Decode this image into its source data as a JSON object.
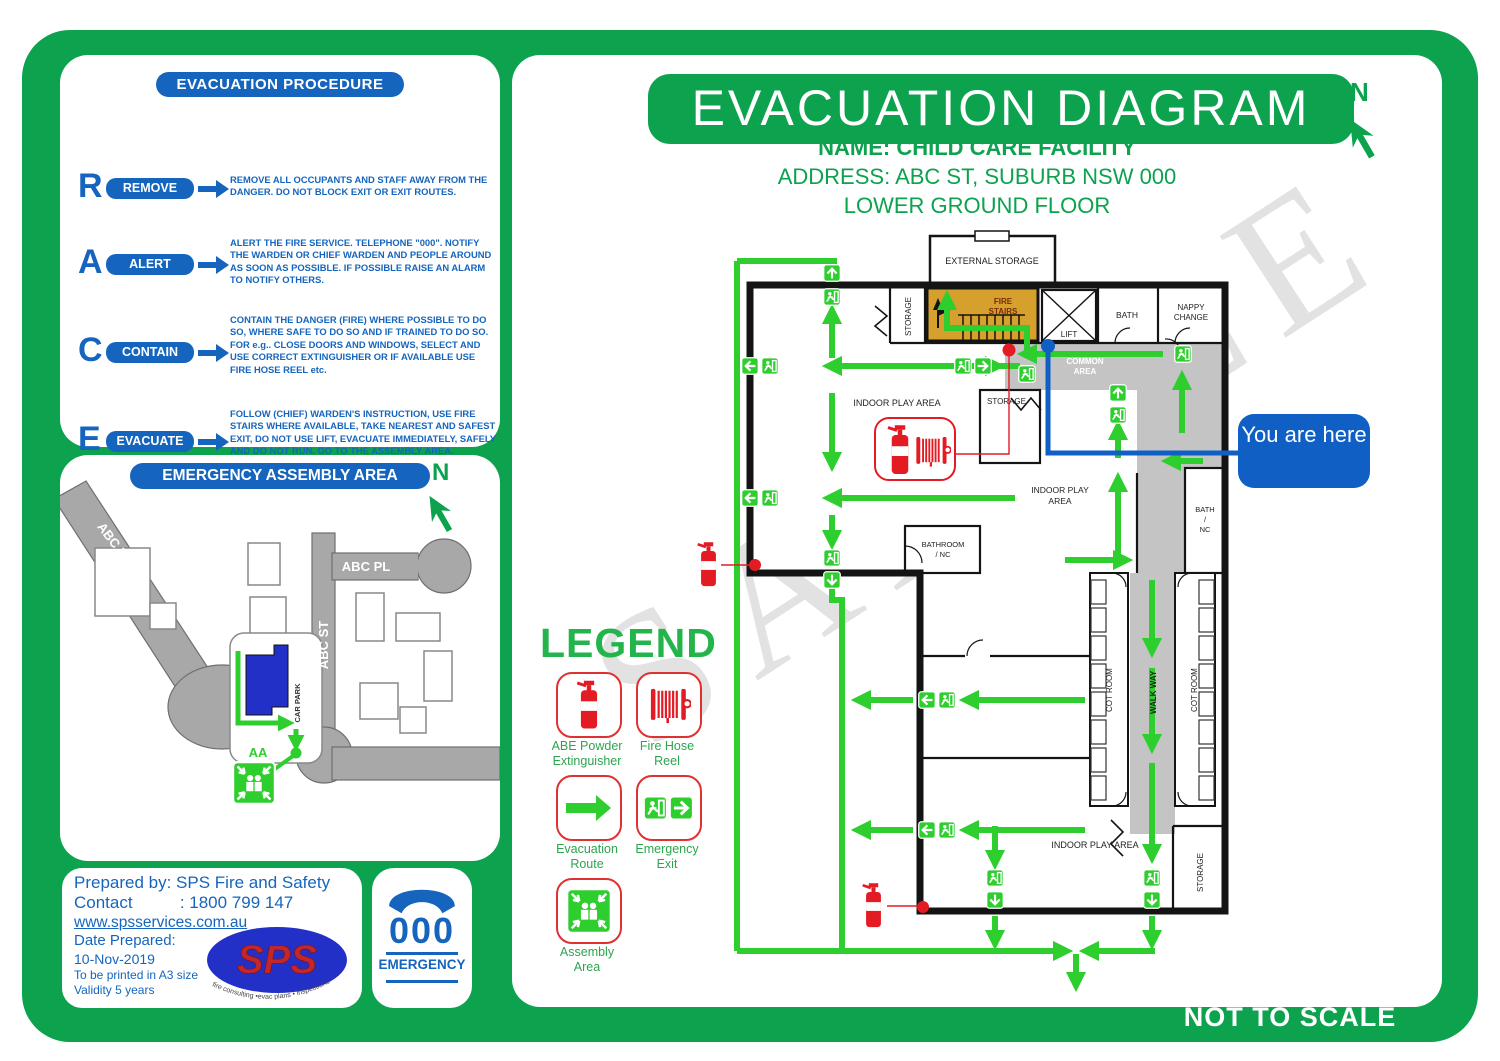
{
  "header": {
    "title": "EVACUATION DIAGRAM",
    "name": "NAME: CHILD CARE FACILITY",
    "address": "ADDRESS: ABC ST, SUBURB NSW 000",
    "floor": "LOWER GROUND FLOOR",
    "north": "N",
    "not_to_scale": "NOT TO SCALE"
  },
  "watermark": "SAMPLE",
  "you_are_here": "You are here",
  "procedure": {
    "title": "EVACUATION PROCEDURE",
    "steps": [
      {
        "letter": "R",
        "label": "REMOVE",
        "text": "REMOVE ALL OCCUPANTS AND STAFF AWAY FROM THE DANGER. DO NOT BLOCK EXIT OR EXIT ROUTES."
      },
      {
        "letter": "A",
        "label": "ALERT",
        "text": "ALERT THE FIRE SERVICE. TELEPHONE \"000\". NOTIFY THE WARDEN OR CHIEF WARDEN AND PEOPLE AROUND AS SOON AS POSSIBLE. IF POSSIBLE RAISE AN ALARM TO NOTIFY OTHERS."
      },
      {
        "letter": "C",
        "label": "CONTAIN",
        "text": "CONTAIN THE DANGER (FIRE) WHERE POSSIBLE TO DO SO, WHERE SAFE TO DO SO AND IF TRAINED TO DO SO. FOR e.g.. CLOSE DOORS AND WINDOWS, SELECT AND USE CORRECT EXTINGUISHER OR IF AVAILABLE USE FIRE HOSE REEL etc."
      },
      {
        "letter": "E",
        "label": "EVACUATE",
        "text": "FOLLOW (CHIEF) WARDEN'S INSTRUCTION, USE FIRE STAIRS WHERE AVAILABLE, TAKE NEAREST AND SAFEST EXIT, DO NOT USE LIFT, EVACUATE IMMEDIATELY, SAFELY AND DO NOT RUN. GO TO THE ASSEMBLY AREA."
      }
    ]
  },
  "assembly_map": {
    "title": "EMERGENCY ASSEMBLY AREA",
    "north": "N",
    "roads": {
      "rd": "ABC RD",
      "pl": "ABC PL",
      "st": "ABC ST"
    },
    "car_park": "CAR PARK",
    "assembly_point": "AA"
  },
  "legend": {
    "title": "LEGEND",
    "items": [
      {
        "icon": "abe-powder-extinguisher-icon",
        "lines": [
          "ABE Powder",
          "Extinguisher"
        ]
      },
      {
        "icon": "fire-hose-reel-icon",
        "lines": [
          "Fire Hose",
          "Reel"
        ]
      },
      {
        "icon": "evacuation-route-icon",
        "lines": [
          "Evacuation",
          "Route"
        ]
      },
      {
        "icon": "emergency-exit-icon",
        "lines": [
          "Emergency",
          "Exit"
        ]
      },
      {
        "icon": "assembly-area-icon",
        "lines": [
          "Assembly",
          "Area"
        ]
      }
    ]
  },
  "floorplan": {
    "rooms": {
      "external_storage": "EXTERNAL STORAGE",
      "storage_top": "STORAGE",
      "fire_stairs": [
        "FIRE",
        "STAIRS"
      ],
      "lift": "LIFT",
      "bath": "BATH",
      "nappy_change": [
        "NAPPY",
        "CHANGE"
      ],
      "common_area": [
        "COMMON",
        "AREA"
      ],
      "storage_mid": "STORAGE",
      "indoor_play_top": "INDOOR PLAY AREA",
      "bathroom_nc": [
        "BATHROOM",
        "/ NC"
      ],
      "indoor_play_right": [
        "INDOOR PLAY",
        "AREA"
      ],
      "bath_nc": [
        "BATH",
        "/",
        "NC"
      ],
      "cot_room_left": "COT ROOM",
      "walk_way": "WALK WAY",
      "cot_room_right": "COT ROOM",
      "indoor_play_bottom": "INDOOR PLAY AREA",
      "storage_bottom": "STORAGE"
    }
  },
  "prepared": {
    "prepared_by": "Prepared by: SPS Fire and Safety",
    "contact": "Contact          : 1800 799 147",
    "website": "www.spsservices.com.au",
    "date_label": "Date Prepared:",
    "date_value": "10-Nov-2019",
    "note1": "To be printed in A3 size",
    "note2": "Validity 5 years",
    "logo_text": "SPS",
    "logo_tagline": "fire consulting •evac plans • inspections"
  },
  "emergency": {
    "number": "000",
    "label": "EMERGENCY"
  },
  "colors": {
    "frame_green": "#0CA24E",
    "route_green": "#2FCE2F",
    "blue": "#1565BE",
    "here_blue": "#0F5FC4",
    "red": "#E31B23",
    "fire_stairs_orange": "#D5A02B",
    "road_gray": "#A8A8A8",
    "area_gray": "#C4C4C4"
  }
}
